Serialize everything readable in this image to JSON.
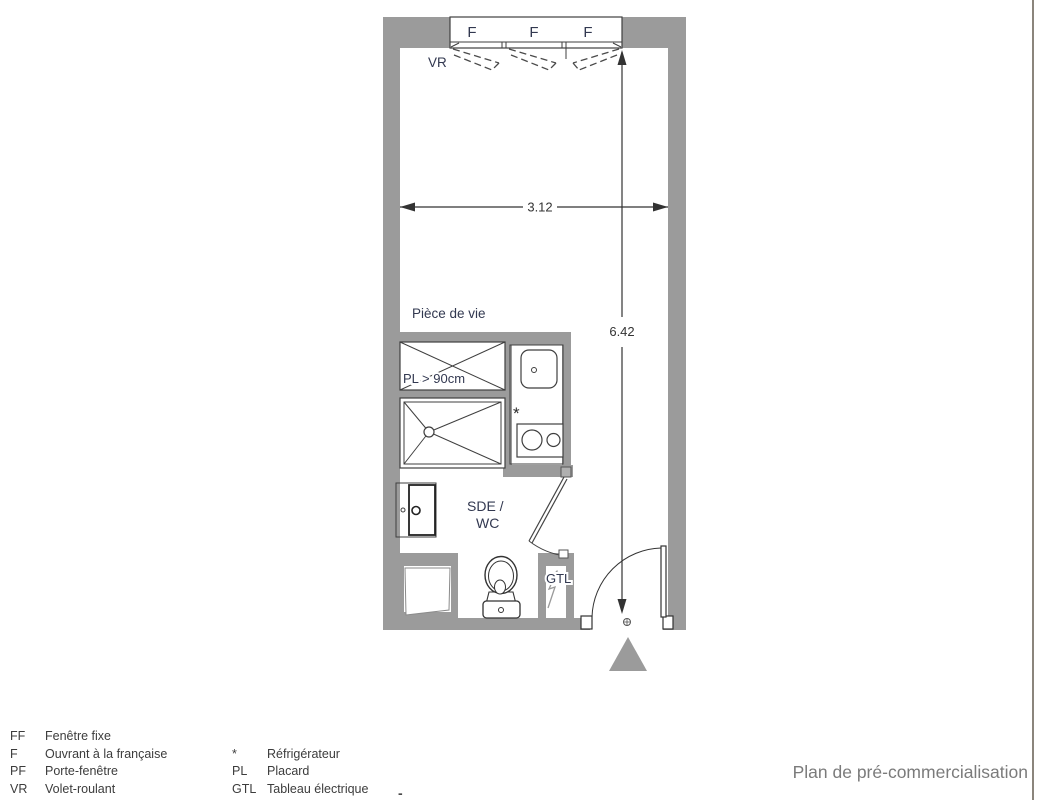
{
  "plan": {
    "title": "Plan de pré-commercialisation",
    "rooms": {
      "living": "Pièce de vie",
      "bathroom_line1": "SDE /",
      "bathroom_line2": "WC"
    },
    "labels": {
      "shutter": "VR",
      "electric_panel": "GTL",
      "closet": "PL > 90cm",
      "fridge_marker": "*"
    },
    "window": {
      "panes": [
        {
          "label": "F"
        },
        {
          "label": "F"
        },
        {
          "label": "F"
        }
      ]
    },
    "dimensions": {
      "width_m": "3.12",
      "height_m": "6.42"
    },
    "colors": {
      "wall": "#9b9b9b",
      "line": "#3f3f3f",
      "label": "#323850",
      "title": "#7b7b7b"
    }
  },
  "legend": {
    "col1": [
      {
        "abbr": "FF",
        "label": "Fenêtre fixe"
      },
      {
        "abbr": "F",
        "label": "Ouvrant à la française"
      },
      {
        "abbr": "PF",
        "label": "Porte-fenêtre"
      },
      {
        "abbr": "VR",
        "label": "Volet-roulant"
      }
    ],
    "col2": [
      {
        "abbr": "*",
        "label": "Réfrigérateur"
      },
      {
        "abbr": "PL",
        "label": "Placard"
      },
      {
        "abbr": "GTL",
        "label": "Tableau électrique"
      }
    ]
  },
  "footer_mark": "-"
}
